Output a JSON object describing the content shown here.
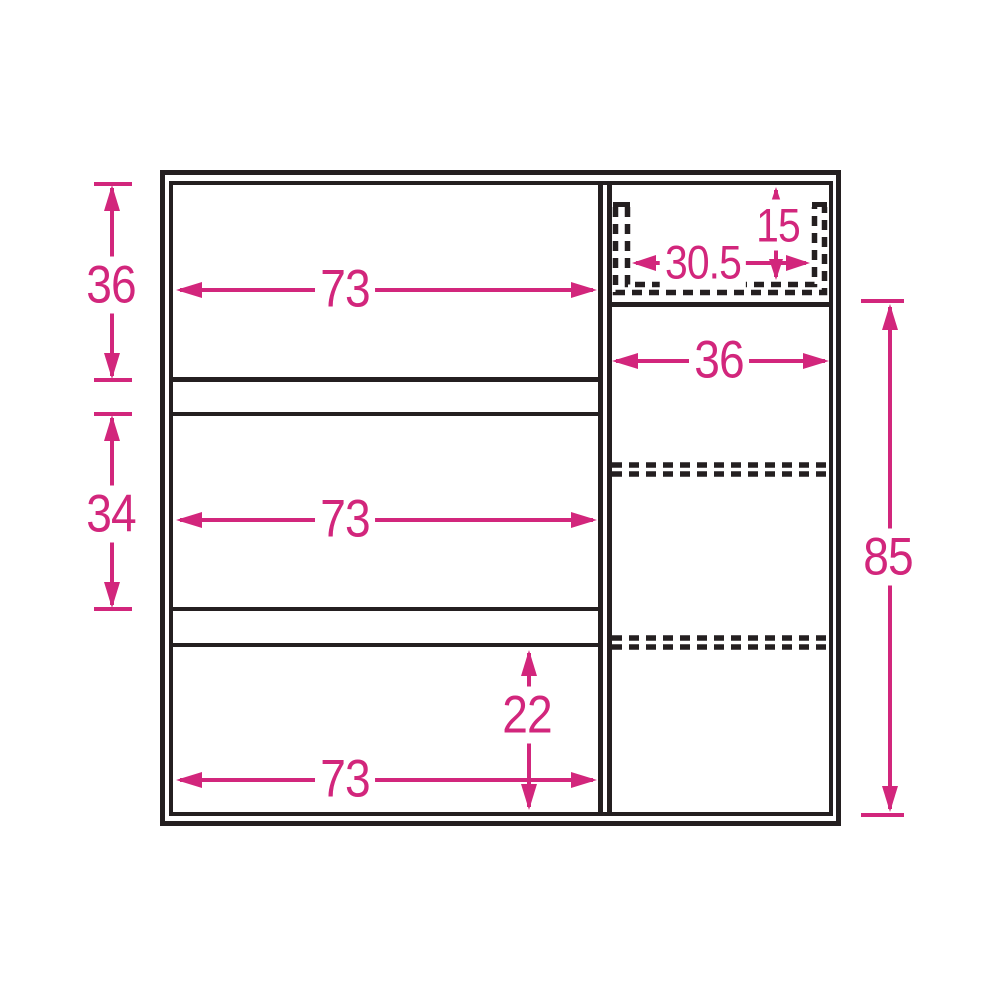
{
  "diagram": {
    "kind": "cabinet-interior-dimension-diagram",
    "sections": {
      "left": "three open shelf compartments",
      "right": "tall compartment with adjustable shelf positions and top cable slot"
    }
  },
  "colors": {
    "dimension_pink": "#d2267c",
    "outline_black": "#241f20",
    "background": "#ffffff"
  },
  "dimensions": {
    "left_top_height": "36",
    "left_middle_height": "34",
    "left_top_width": "73",
    "left_middle_width": "73",
    "left_bottom_width": "73",
    "left_bottom_height": "22",
    "slot_height": "15",
    "slot_width": "30.5",
    "right_inner_width": "36",
    "right_inner_height": "85"
  }
}
